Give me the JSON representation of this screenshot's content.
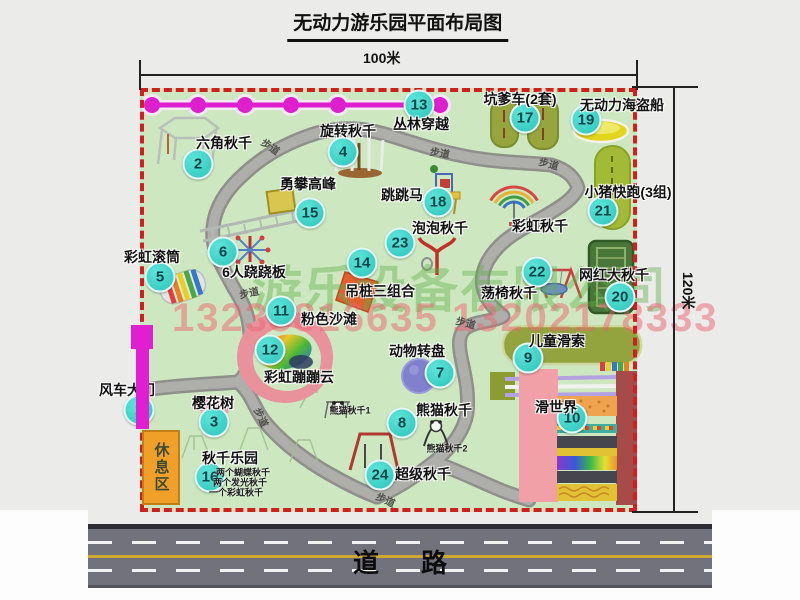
{
  "title": "无动力游乐园平面布局图",
  "dimensions": {
    "width": "100米",
    "height": "120米"
  },
  "road_label": "道路",
  "rest_area_label": "休息区",
  "walkway_label": "步道",
  "watermark": {
    "company": "游乐设备有限公司",
    "phone": "13233816635 13202178333"
  },
  "attractions": [
    {
      "num": "1",
      "name": "风车大门",
      "bx": 139,
      "by": 410,
      "lx": 127,
      "ly": 390
    },
    {
      "num": "2",
      "name": "六角秋千",
      "bx": 198,
      "by": 164,
      "lx": 224,
      "ly": 143
    },
    {
      "num": "3",
      "name": "樱花树",
      "bx": 214,
      "by": 422,
      "lx": 213,
      "ly": 403
    },
    {
      "num": "4",
      "name": "旋转秋千",
      "bx": 343,
      "by": 152,
      "lx": 348,
      "ly": 131
    },
    {
      "num": "5",
      "name": "彩虹滚筒",
      "bx": 160,
      "by": 277,
      "lx": 152,
      "ly": 257
    },
    {
      "num": "6",
      "name": "6人跷跷板",
      "bx": 223,
      "by": 252,
      "lx": 254,
      "ly": 272
    },
    {
      "num": "7",
      "name": "动物转盘",
      "bx": 440,
      "by": 373,
      "lx": 417,
      "ly": 351
    },
    {
      "num": "8",
      "name": "熊猫秋千",
      "bx": 402,
      "by": 423,
      "lx": 444,
      "ly": 410
    },
    {
      "num": "9",
      "name": "儿童滑索",
      "bx": 528,
      "by": 358,
      "lx": 557,
      "ly": 341
    },
    {
      "num": "10",
      "name": "滑世界",
      "bx": 572,
      "by": 418,
      "lx": 556,
      "ly": 407
    },
    {
      "num": "11",
      "name": "粉色沙滩",
      "bx": 281,
      "by": 311,
      "lx": 329,
      "ly": 319
    },
    {
      "num": "12",
      "name": "彩虹蹦蹦云",
      "bx": 270,
      "by": 350,
      "lx": 299,
      "ly": 377
    },
    {
      "num": "13",
      "name": "丛林穿越",
      "bx": 419,
      "by": 105,
      "lx": 421,
      "ly": 124
    },
    {
      "num": "14",
      "name": "吊桩三组合",
      "bx": 362,
      "by": 263,
      "lx": 380,
      "ly": 291
    },
    {
      "num": "15",
      "name": "勇攀高峰",
      "bx": 310,
      "by": 213,
      "lx": 308,
      "ly": 184
    },
    {
      "num": "16",
      "name": "秋千乐园",
      "bx": 210,
      "by": 477,
      "lx": 230,
      "ly": 458
    },
    {
      "num": "17",
      "name": "坑爹车(2套)",
      "bx": 525,
      "by": 118,
      "lx": 520,
      "ly": 99
    },
    {
      "num": "18",
      "name": "跳跳马",
      "bx": 438,
      "by": 202,
      "lx": 402,
      "ly": 195
    },
    {
      "num": "19",
      "name": "无动力海盗船",
      "bx": 586,
      "by": 120,
      "lx": 622,
      "ly": 105
    },
    {
      "num": "20",
      "name": "网红大秋千",
      "bx": 620,
      "by": 297,
      "lx": 614,
      "ly": 275
    },
    {
      "num": "21",
      "name": "小猪快跑(3组)",
      "bx": 603,
      "by": 211,
      "lx": 628,
      "ly": 192
    },
    {
      "num": "22",
      "name": "荡椅秋千",
      "bx": 537,
      "by": 272,
      "lx": 509,
      "ly": 293
    },
    {
      "num": "23",
      "name": "泡泡秋千",
      "bx": 400,
      "by": 243,
      "lx": 440,
      "ly": 228
    },
    {
      "num": "24",
      "name": "超级秋千",
      "bx": 380,
      "by": 475,
      "lx": 423,
      "ly": 474
    },
    {
      "num": "",
      "name": "彩虹秋千",
      "lx": 540,
      "ly": 226
    }
  ],
  "notes": [
    {
      "text": "熊猫秋千1",
      "x": 350,
      "y": 410
    },
    {
      "text": "熊猫秋千2",
      "x": 447,
      "y": 448
    },
    {
      "text": "两个蝴蝶秋千",
      "x": 243,
      "y": 472
    },
    {
      "text": "两个发光秋千",
      "x": 240,
      "y": 482
    },
    {
      "text": "一个彩虹秋千",
      "x": 236,
      "y": 492
    }
  ],
  "walkways": [
    {
      "x": 271,
      "y": 146,
      "r": 35
    },
    {
      "x": 440,
      "y": 152,
      "r": 10
    },
    {
      "x": 549,
      "y": 163,
      "r": 15
    },
    {
      "x": 249,
      "y": 292,
      "r": -12
    },
    {
      "x": 262,
      "y": 417,
      "r": 65
    },
    {
      "x": 466,
      "y": 322,
      "r": 15
    },
    {
      "x": 386,
      "y": 499,
      "r": 25
    }
  ]
}
